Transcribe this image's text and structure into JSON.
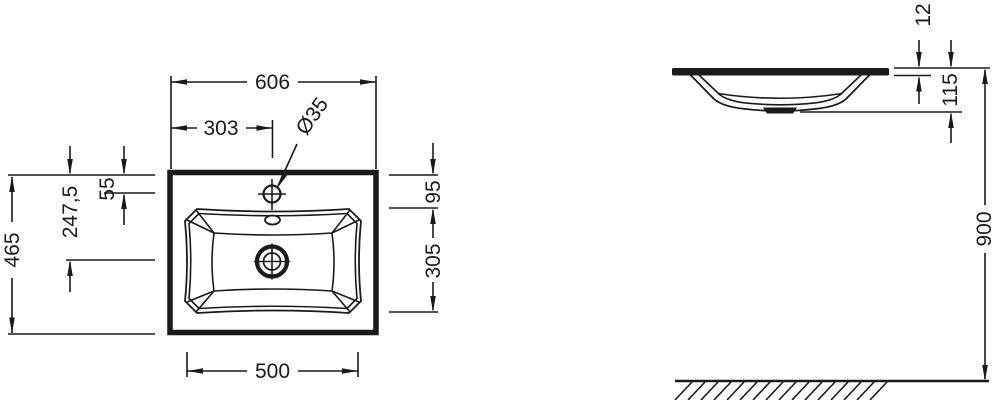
{
  "colors": {
    "line": "#1a1a1a",
    "background": "#ffffff"
  },
  "plan_view": {
    "dims": {
      "total_width": "606",
      "faucet_offset_x": "303",
      "faucet_hole_diameter": "Ø35",
      "faucet_offset_y": "55",
      "drain_center_offset": "247,5",
      "total_depth": "465",
      "basin_top_offset": "95",
      "basin_inner_depth": "305",
      "basin_inner_width": "500"
    }
  },
  "side_view": {
    "dims": {
      "rim_thickness": "12",
      "basin_depth": "115",
      "installation_height": "900"
    }
  }
}
